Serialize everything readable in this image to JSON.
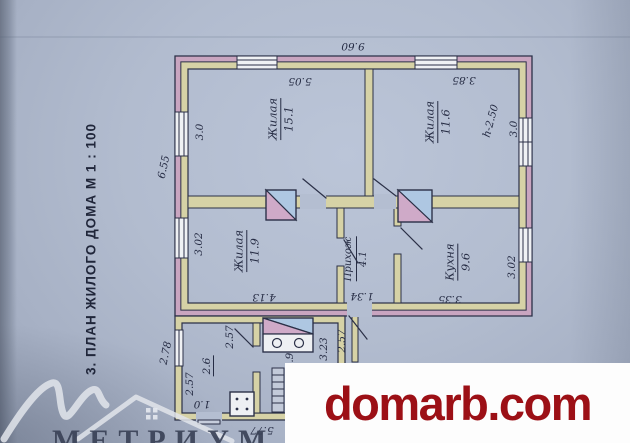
{
  "caption": "3. ПЛАН ЖИЛОГО ДОМА М 1 : 100",
  "plan": {
    "rooms": {
      "living1": {
        "label": "Жилая",
        "area": "15.1"
      },
      "living2": {
        "label": "Жилая",
        "area": "11.6"
      },
      "living3": {
        "label": "Жилая",
        "area": "11.9"
      },
      "hallway": {
        "label": "Прихож",
        "area": "4.1"
      },
      "kitchen": {
        "label": "Кухня",
        "area": "9.6"
      }
    },
    "dimensions": {
      "overall_top": "9.60",
      "living1_width": "5.05",
      "living2_width": "3.85",
      "living1_left": "3.0",
      "left_total": "6.55",
      "living3_left": "3.02",
      "ceiling_height": "h-2.50",
      "living2_right": "3.0",
      "kitchen_right": "3.02",
      "living3_width": "4.13",
      "hallway_width": "1.34",
      "kitchen_width": "3.35",
      "annex_left": "2.78",
      "annex_left_lower": "2.57",
      "annex_room_area": "2.6",
      "annex_partition": "2.57",
      "annex_door": "1.0",
      "annex_stove_side": "2.9",
      "hall_lower": "3.23",
      "hall_lower2": "2.57",
      "annex_bottom": "5.77"
    }
  },
  "watermark": {
    "text": "domarb.com",
    "color": "#9c1016"
  },
  "logo": {
    "text": "МЕТРИУМ"
  },
  "colors": {
    "paper": "#aeb8cb",
    "ink": "#2b3047",
    "wall_outer_band": "#c9a5c0",
    "wall_inner_band": "#d6d2a6",
    "stove_blue": "#aec7e2",
    "stove_pink": "#cfaac8",
    "watermark_red": "#9c1016",
    "logo_gray": "#e2e5eb"
  }
}
